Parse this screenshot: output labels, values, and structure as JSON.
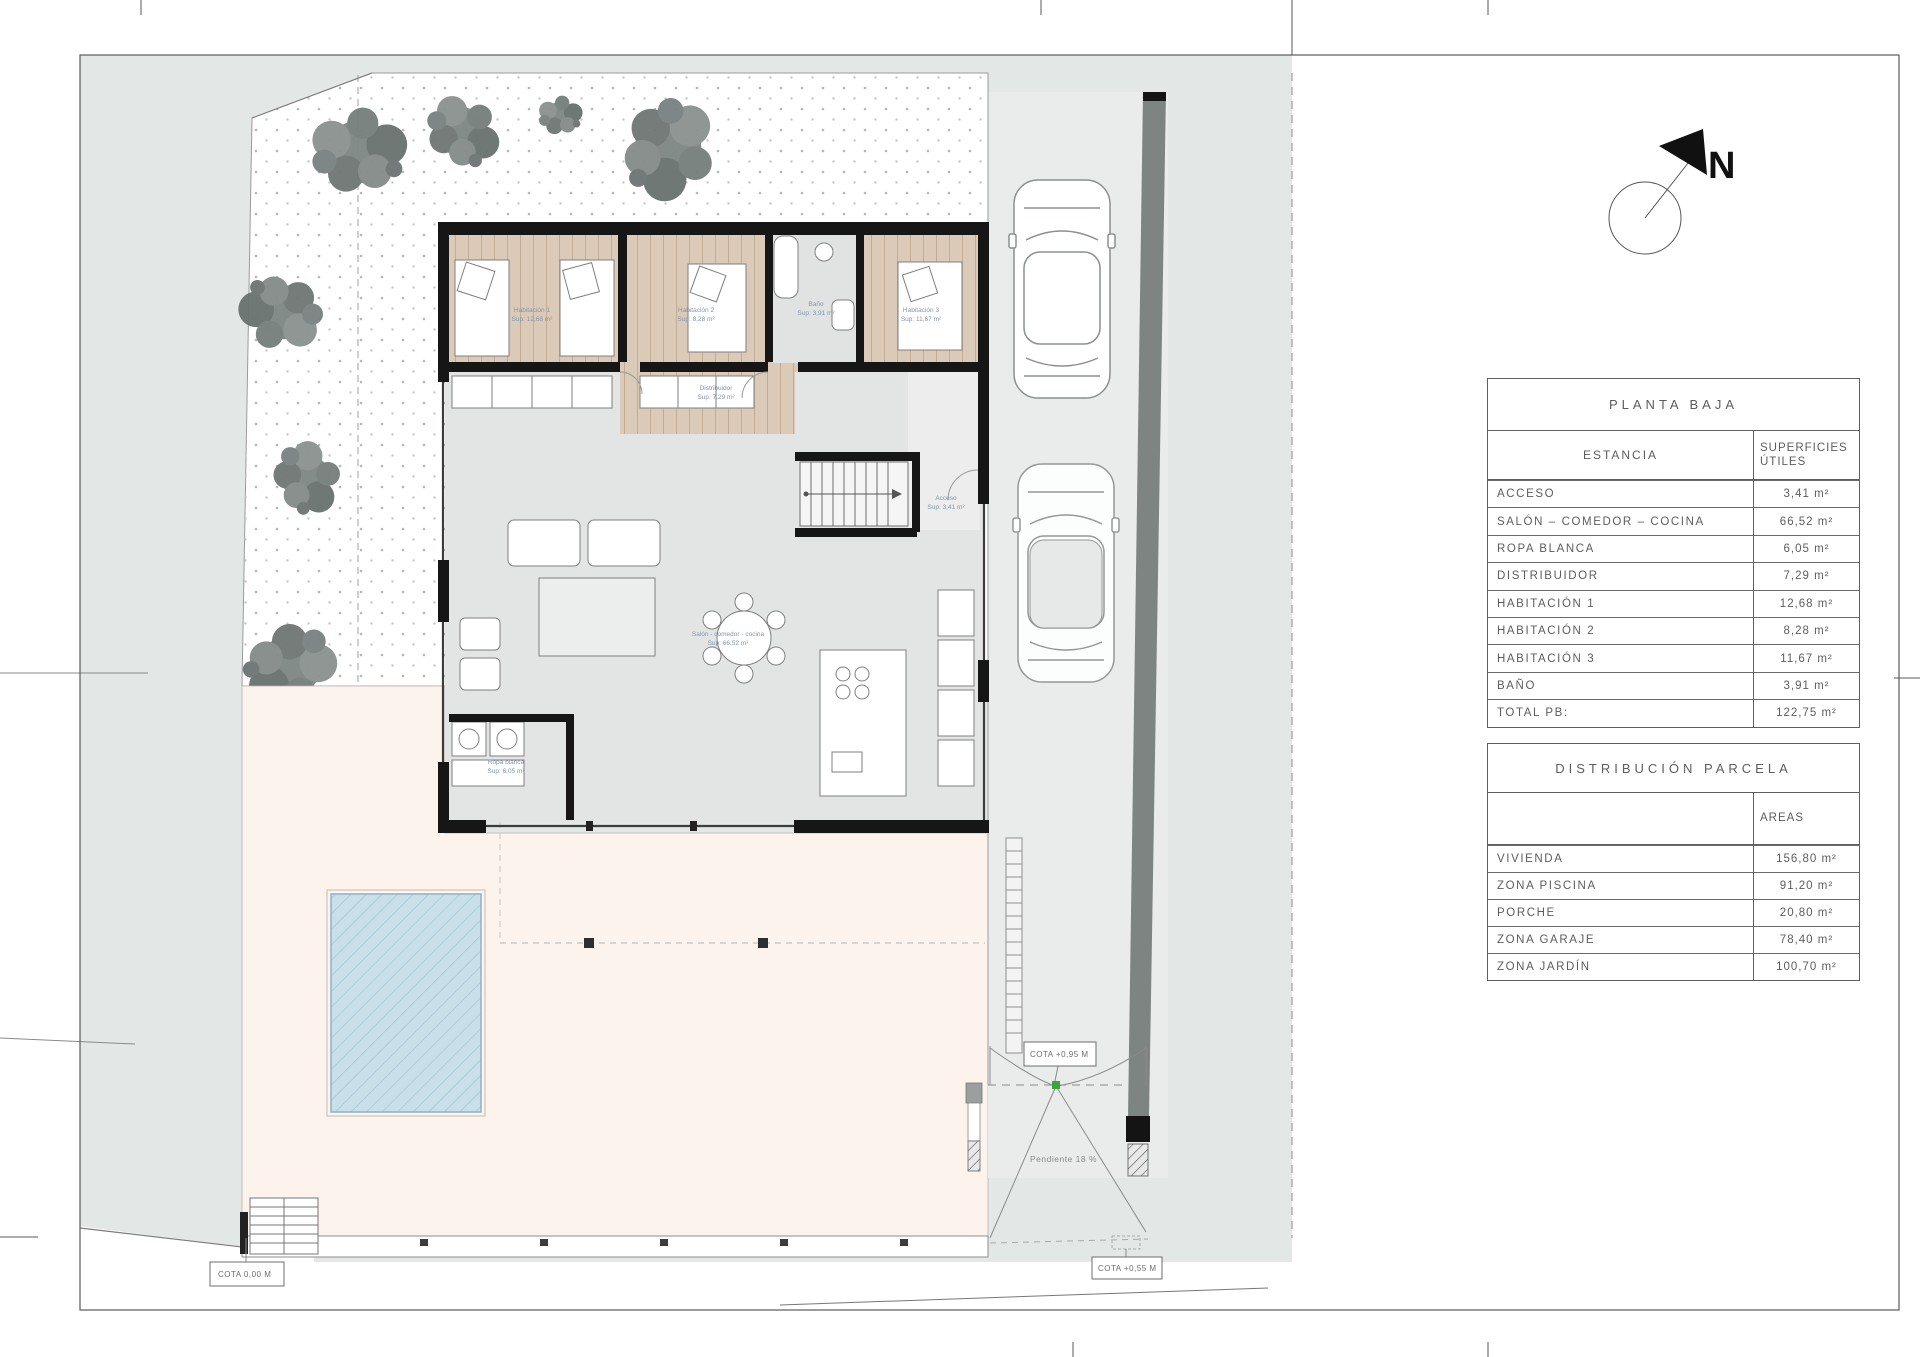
{
  "north": {
    "label": "N"
  },
  "tables": {
    "planta_baja": {
      "title": "PLANTA BAJA",
      "col_estancia": "ESTANCIA",
      "col_superficies_l1": "SUPERFICIES",
      "col_superficies_l2": "ÚTILES",
      "rows": [
        {
          "name": "ACCESO",
          "area": "3,41 m²"
        },
        {
          "name": "SALÓN – COMEDOR – COCINA",
          "area": "66,52 m²"
        },
        {
          "name": "ROPA BLANCA",
          "area": "6,05 m²"
        },
        {
          "name": "DISTRIBUIDOR",
          "area": "7,29 m²"
        },
        {
          "name": "HABITACIÓN 1",
          "area": "12,68 m²"
        },
        {
          "name": "HABITACIÓN 2",
          "area": "8,28 m²"
        },
        {
          "name": "HABITACIÓN 3",
          "area": "11,67 m²"
        },
        {
          "name": "BAÑO",
          "area": "3,91 m²"
        },
        {
          "name": "TOTAL PB:",
          "area": "122,75 m²"
        }
      ]
    },
    "parcela": {
      "title": "DISTRIBUCIÓN PARCELA",
      "col_areas": "AREAS",
      "rows": [
        {
          "name": "VIVIENDA",
          "area": "156,80 m²"
        },
        {
          "name": "ZONA PISCINA",
          "area": "91,20 m²"
        },
        {
          "name": "PORCHE",
          "area": "20,80 m²"
        },
        {
          "name": "ZONA GARAJE",
          "area": "78,40 m²"
        },
        {
          "name": "ZONA JARDÍN",
          "area": "100,70 m²"
        }
      ]
    }
  },
  "plan": {
    "cota_access": "COTA 0,00 M",
    "cota_gate": "COTA +0,95 M",
    "cota_street": "COTA +0,55 M",
    "pendiente": "Pendiente 18 %",
    "rooms": [
      {
        "name": "Habitación 1",
        "sup": "Sup: 12,68 m²"
      },
      {
        "name": "Habitación 2",
        "sup": "Sup: 8,28 m²"
      },
      {
        "name": "Baño",
        "sup": "Sup: 3,91 m²"
      },
      {
        "name": "Habitación 3",
        "sup": "Sup: 11,67 m²"
      },
      {
        "name": "Distribuidor",
        "sup": "Sup: 7,29 m²"
      },
      {
        "name": "Acceso",
        "sup": "Sup: 3,41 m²"
      },
      {
        "name": "Ropa blanca",
        "sup": "Sup: 6,05 m²"
      },
      {
        "name": "Salón - comedor - cocina",
        "sup": "Sup: 66,52 m²"
      }
    ]
  }
}
